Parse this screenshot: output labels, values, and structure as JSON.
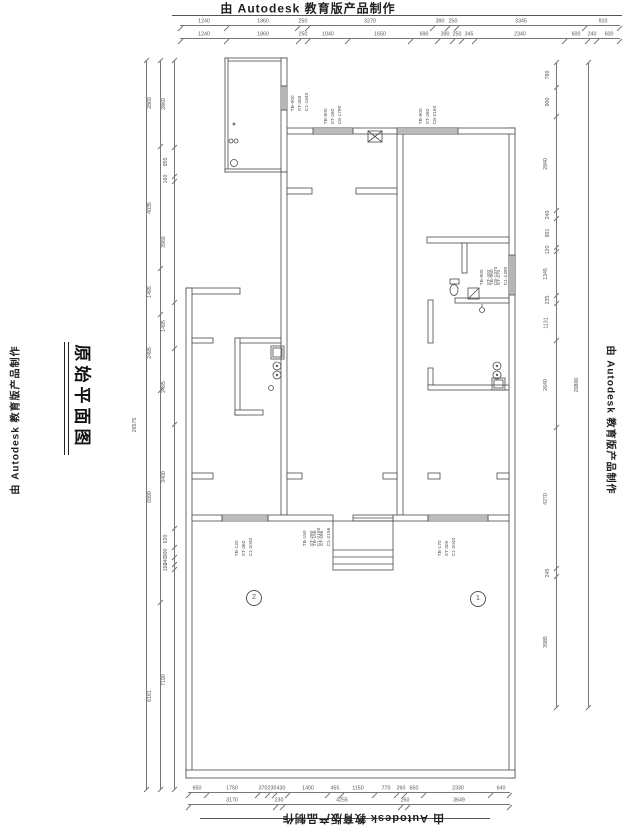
{
  "branding": {
    "top": "由 Autodesk 教育版产品制作",
    "bottom": "由 Autodesk 教育版产品制作",
    "left": "由 Autodesk 教育版产品制作",
    "right": "由 Autodesk 教育版产品制作"
  },
  "title_block": {
    "text": "原始平面图"
  },
  "dims": {
    "top1": [
      "1240",
      "1860",
      "250",
      "3270",
      "390",
      "250",
      "3345",
      "910"
    ],
    "top2": [
      "1240",
      "1860",
      "250",
      "1040",
      "1650",
      "690",
      "390",
      "250",
      "345",
      "2340",
      "600",
      "240",
      "600"
    ],
    "bottom1": [
      "650",
      "1750",
      "370",
      "230",
      "430",
      "1400",
      "455",
      "1150",
      "770",
      "260",
      "650",
      "2330",
      "640"
    ],
    "bottom2": [
      "3170",
      "230",
      "4255",
      "260",
      "3649"
    ],
    "left_outer": [
      "26575"
    ],
    "left_mid": [
      "2860",
      "4035",
      "1495",
      "2495",
      "6990",
      "6161"
    ],
    "left_inner": [
      "2860",
      "955",
      "160",
      "3966",
      "1495",
      "2495",
      "3400",
      "620",
      "300",
      "240",
      "160",
      "7190"
    ],
    "right_inner": [
      "780",
      "900",
      "2840",
      "240",
      "901",
      "120",
      "1345",
      "235",
      "1131",
      "2640",
      "4270",
      "245",
      "3985"
    ],
    "right_outer": [
      "20800"
    ]
  },
  "plan": {
    "window_labels": [
      {
        "lines": [
          "TB-900",
          "ST-305",
          "C1-1840"
        ]
      },
      {
        "lines": [
          "TB-900",
          "ST-280",
          "C8-1790"
        ]
      },
      {
        "lines": [
          "TB-900",
          "ST-280",
          "C8-2160"
        ]
      },
      {
        "lines": [
          "TB-900",
          "ST-400",
          "C8-1370"
        ]
      },
      {
        "lines": [
          "TB-960",
          "ST-270",
          "C1-1390"
        ]
      },
      {
        "lines": [
          "TB-120",
          "ST-360",
          "C1-2040"
        ]
      },
      {
        "lines": [
          "TB-150",
          "ST-290",
          "C1-2150"
        ]
      },
      {
        "lines": [
          "TB-156",
          "ST-296",
          "C1-2156"
        ]
      },
      {
        "lines": [
          "TB-170",
          "ST-300",
          "C1-2040"
        ]
      }
    ],
    "markers": [
      {
        "label": "2"
      },
      {
        "label": "1"
      }
    ]
  }
}
